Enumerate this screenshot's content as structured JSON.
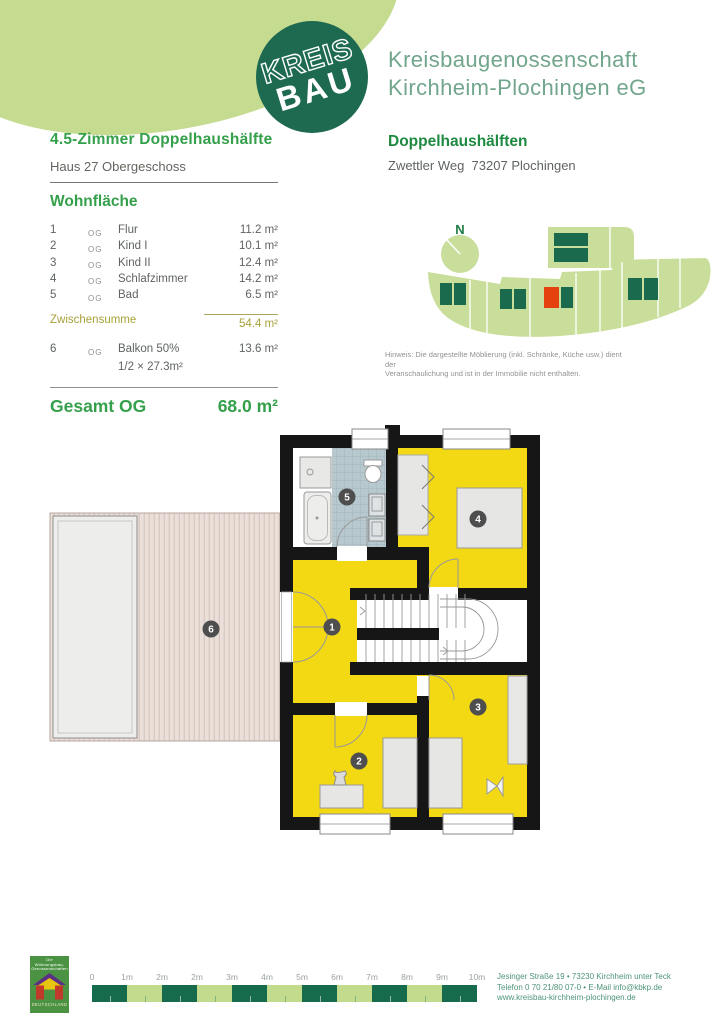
{
  "header": {
    "logo_top": "KREIS",
    "logo_bottom": "BAU",
    "company_line1": "Kreisbaugenossenschaft",
    "company_line2": "Kirchheim-Plochingen eG"
  },
  "left_column": {
    "title": "4.5-Zimmer Doppelhaushälfte",
    "subtitle": "Haus 27 Obergeschoss",
    "section_title": "Wohnfläche",
    "rows": [
      {
        "num": "1",
        "floor": "OG",
        "name": "Flur",
        "area": "11.2 m²"
      },
      {
        "num": "2",
        "floor": "OG",
        "name": "Kind I",
        "area": "10.1 m²"
      },
      {
        "num": "3",
        "floor": "OG",
        "name": "Kind II",
        "area": "12.4 m²"
      },
      {
        "num": "4",
        "floor": "OG",
        "name": "Schlafzimmer",
        "area": "14.2 m²"
      },
      {
        "num": "5",
        "floor": "OG",
        "name": "Bad",
        "area": "6.5 m²"
      }
    ],
    "subtotal": {
      "label": "Zwischensumme",
      "value": "54.4 m²"
    },
    "balcony_row": {
      "num": "6",
      "floor": "OG",
      "name": "Balkon 50%",
      "area": "13.6 m²",
      "note": "1/2 × 27.3m²"
    },
    "total": {
      "label": "Gesamt OG",
      "value": "68.0 m²"
    }
  },
  "right_column": {
    "title": "Doppelhaushälften",
    "address": "Zwettler Weg  73207 Plochingen",
    "north_label": "N",
    "hinweis_line1": "Hinweis: Die dargestellte Möblierung (inkl. Schränke, Küche usw.) dient der",
    "hinweis_line2": "Veranschaulichung und ist in der Immobilie nicht enthalten."
  },
  "floor_plan": {
    "room_labels": {
      "flur": "1",
      "kind1": "2",
      "kind2": "3",
      "schlafzimmer": "4",
      "bad": "5",
      "balkon": "6"
    }
  },
  "footer": {
    "scale_labels": [
      "0",
      "1m",
      "2m",
      "2m",
      "3m",
      "4m",
      "5m",
      "6m",
      "7m",
      "8m",
      "9m",
      "10m"
    ],
    "address_line1": "Jesinger Straße 19 • 73230 Kirchheim unter Teck",
    "address_line2": "Telefon 0 70 21/80 07-0 • E-Mail info@kbkp.de",
    "address_line3": "www.kreisbau-kirchheim-plochingen.de",
    "emblem_line1": "Die Wohnungsbau-",
    "emblem_line2": "Genossenschaften",
    "emblem_line3": "DEUTSCHLAND"
  },
  "colors": {
    "accent_green": "#35A04B",
    "brand_dark_green": "#1E6A50",
    "blob_light_green": "#C5DB90",
    "room_yellow": "#F3D814",
    "tile_blue": "#B7C9CE",
    "highlight_red": "#E5410F",
    "subtotal_olive": "#A8A23B",
    "scale_dark": "#166B4D",
    "scale_light": "#C2DB8D",
    "footer_text_green": "#4E9478"
  }
}
